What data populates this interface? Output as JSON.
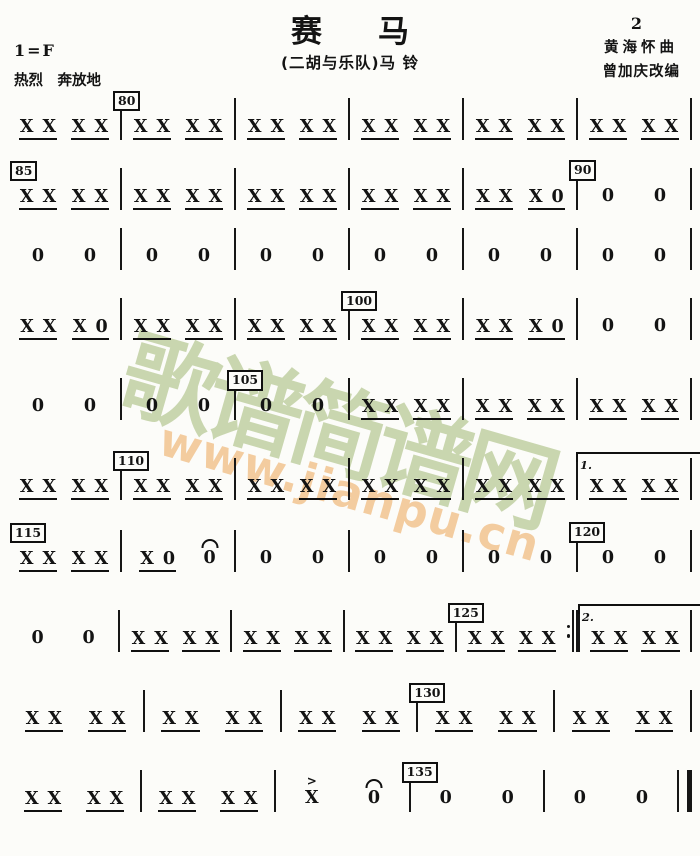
{
  "header": {
    "title": "赛马",
    "page_number": "2",
    "subtitle": "(二胡与乐队)马 铃",
    "composer": "黄海怀曲",
    "arranger": "曾加庆改编",
    "key_signature": "1=F",
    "tempo": "热烈　奔放地"
  },
  "watermark": {
    "site_name": "歌谱简谱网",
    "site_url": "www.jianpu.cn",
    "green_color": "#bdcd9d",
    "orange_color": "#f2c490"
  },
  "score": {
    "glyphs": {
      "strike": "X",
      "rest": "0",
      "accent": ">"
    },
    "lines": [
      {
        "measures": [
          {
            "beats": [
              "xx",
              "xx"
            ]
          },
          {
            "beats": [
              "xx",
              "xx"
            ],
            "box": "80"
          },
          {
            "beats": [
              "xx",
              "xx"
            ]
          },
          {
            "beats": [
              "xx",
              "xx"
            ]
          },
          {
            "beats": [
              "xx",
              "xx"
            ]
          },
          {
            "beats": [
              "xx",
              "xx"
            ]
          }
        ]
      },
      {
        "measures": [
          {
            "beats": [
              "xx",
              "xx"
            ],
            "box": "85"
          },
          {
            "beats": [
              "xx",
              "xx"
            ]
          },
          {
            "beats": [
              "xx",
              "xx"
            ]
          },
          {
            "beats": [
              "xx",
              "xx"
            ]
          },
          {
            "beats": [
              "xx",
              "x0"
            ]
          },
          {
            "beats": [
              "0",
              "0"
            ],
            "box": "90"
          }
        ]
      },
      {
        "measures": [
          {
            "beats": [
              "0",
              "0"
            ]
          },
          {
            "beats": [
              "0",
              "0"
            ]
          },
          {
            "beats": [
              "0",
              "0"
            ]
          },
          {
            "beats": [
              "0",
              "0"
            ]
          },
          {
            "beats": [
              "0",
              "0"
            ]
          },
          {
            "beats": [
              "0",
              "0"
            ]
          }
        ]
      },
      {
        "measures": [
          {
            "beats": [
              "xx",
              "x0"
            ]
          },
          {
            "beats": [
              "xx",
              "xx"
            ]
          },
          {
            "beats": [
              "xx",
              "xx"
            ]
          },
          {
            "beats": [
              "xx",
              "xx"
            ],
            "box": "100"
          },
          {
            "beats": [
              "xx",
              "x0"
            ]
          },
          {
            "beats": [
              "0",
              "0"
            ]
          }
        ]
      },
      {
        "measures": [
          {
            "beats": [
              "0",
              "0"
            ]
          },
          {
            "beats": [
              "0",
              "0"
            ]
          },
          {
            "beats": [
              "0",
              "0"
            ],
            "box": "105"
          },
          {
            "beats": [
              "xx",
              "xx"
            ]
          },
          {
            "beats": [
              "xx",
              "xx"
            ]
          },
          {
            "beats": [
              "xx",
              "xx"
            ]
          }
        ]
      },
      {
        "measures": [
          {
            "beats": [
              "xx",
              "xx"
            ]
          },
          {
            "beats": [
              "xx",
              "xx"
            ],
            "box": "110"
          },
          {
            "beats": [
              "xx",
              "xx"
            ]
          },
          {
            "beats": [
              "xx",
              "xx"
            ]
          },
          {
            "beats": [
              "xx",
              "xx"
            ]
          },
          {
            "beats": [
              "xx",
              "xx"
            ],
            "volta": "1."
          }
        ]
      },
      {
        "measures": [
          {
            "beats": [
              "xx",
              "xx"
            ],
            "box": "115"
          },
          {
            "beats": [
              "x0",
              "0^"
            ]
          },
          {
            "beats": [
              "0",
              "0"
            ]
          },
          {
            "beats": [
              "0",
              "0"
            ]
          },
          {
            "beats": [
              "0",
              "0"
            ]
          },
          {
            "beats": [
              "0",
              "0"
            ],
            "box": "120"
          }
        ]
      },
      {
        "measures": [
          {
            "beats": [
              "0",
              "0"
            ]
          },
          {
            "beats": [
              "xx",
              "xx"
            ]
          },
          {
            "beats": [
              "xx",
              "xx"
            ]
          },
          {
            "beats": [
              "xx",
              "xx"
            ]
          },
          {
            "beats": [
              "xx",
              "xx"
            ],
            "box": "125",
            "bar_after": "repeat"
          },
          {
            "beats": [
              "xx",
              "xx"
            ],
            "volta": "2."
          }
        ]
      },
      {
        "measures": [
          {
            "beats": [
              "xx",
              "xx"
            ]
          },
          {
            "beats": [
              "xx",
              "xx"
            ]
          },
          {
            "beats": [
              "xx",
              "xx"
            ]
          },
          {
            "beats": [
              "xx",
              "xx"
            ],
            "box": "130"
          },
          {
            "beats": [
              "xx",
              "xx"
            ]
          }
        ]
      },
      {
        "measures": [
          {
            "beats": [
              "xx",
              "xx"
            ]
          },
          {
            "beats": [
              "xx",
              "xx"
            ]
          },
          {
            "beats": [
              "x>",
              "0^"
            ]
          },
          {
            "beats": [
              "0",
              "0"
            ],
            "box": "135"
          },
          {
            "beats": [
              "0",
              "0"
            ]
          }
        ],
        "end_bar": "final"
      }
    ]
  }
}
